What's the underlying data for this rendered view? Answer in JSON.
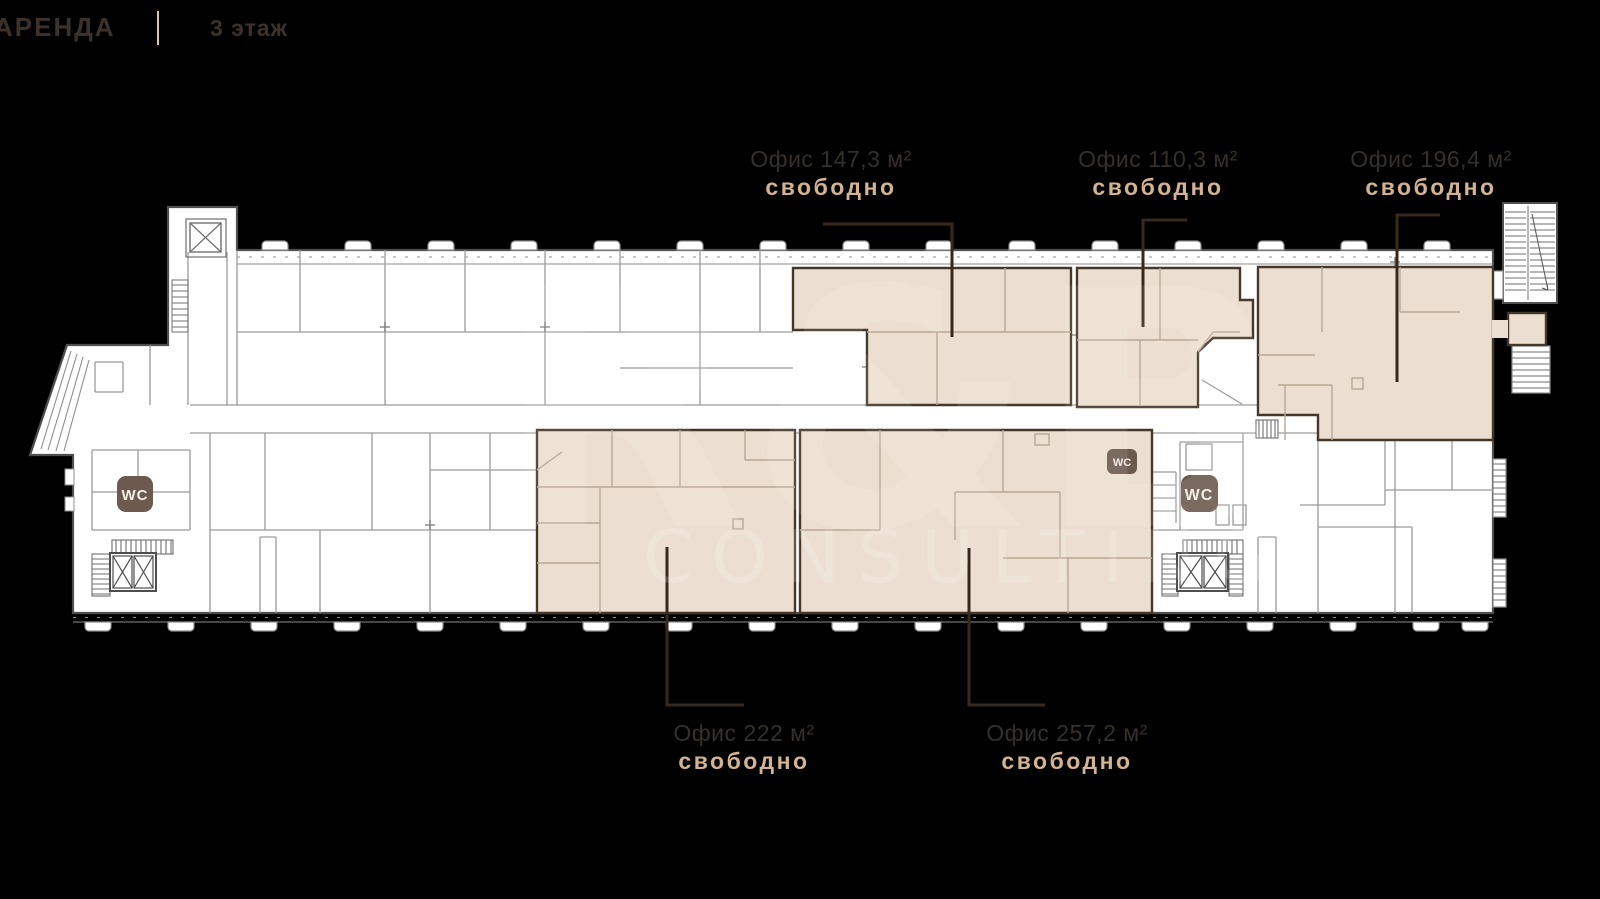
{
  "header": {
    "brand": "АРЕНДА",
    "floor": "3 этаж"
  },
  "watermark": {
    "line1": "R&B",
    "line2": "CONSULTING"
  },
  "offices": [
    {
      "id": "office-147-3",
      "name": "Офис 147,3 м²",
      "status": "свободно"
    },
    {
      "id": "office-110-3",
      "name": "Офис 110,3 м²",
      "status": "свободно"
    },
    {
      "id": "office-196-4",
      "name": "Офис 196,4 м²",
      "status": "свободно"
    },
    {
      "id": "office-222",
      "name": "Офис 222 м²",
      "status": "свободно"
    },
    {
      "id": "office-257-2",
      "name": "Офис 257,2 м²",
      "status": "свободно"
    }
  ],
  "wc_labels": {
    "left": "WC",
    "middle_small": "WC",
    "middle_large": "WC"
  },
  "colors": {
    "background": "#000000",
    "plan_fill": "#ffffff",
    "highlight_fill": "#ecdfd1",
    "highlight_outline": "#463728",
    "office_text": "#35302b",
    "status_text": "#d3b392",
    "leader_line": "#37291d",
    "wc_badge": "#6b5a4d",
    "header_text": "#3c322b",
    "header_divider": "#ddc6af"
  }
}
